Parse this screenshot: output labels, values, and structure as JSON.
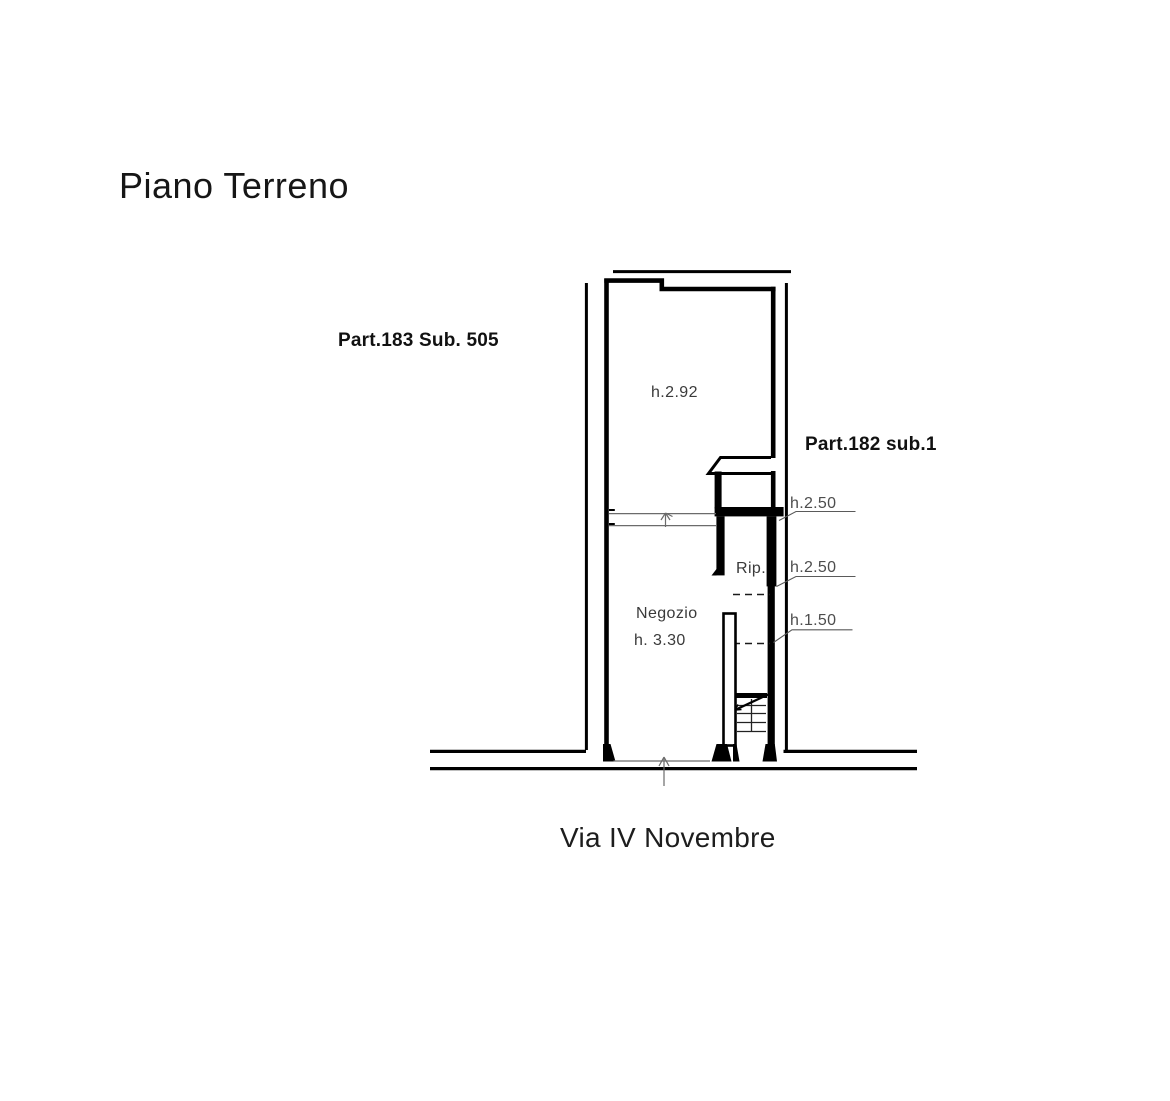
{
  "title": "Piano Terreno",
  "street": "Via IV Novembre",
  "labels": {
    "parcel_left": "Part.183 Sub. 505",
    "parcel_right": "Part.182 sub.1"
  },
  "rooms": {
    "upper_height": "h.2.92",
    "shop": "Negozio",
    "shop_height": "h. 3.30",
    "closet": "Rip."
  },
  "heights": {
    "top": "h.2.50",
    "mid": "h.2.50",
    "low": "h.1.50"
  },
  "colors": {
    "ink": "#1a1a1a",
    "wall": "#000000",
    "dim_text": "#4d4d4d",
    "thin_line": "#6b6b6b"
  }
}
